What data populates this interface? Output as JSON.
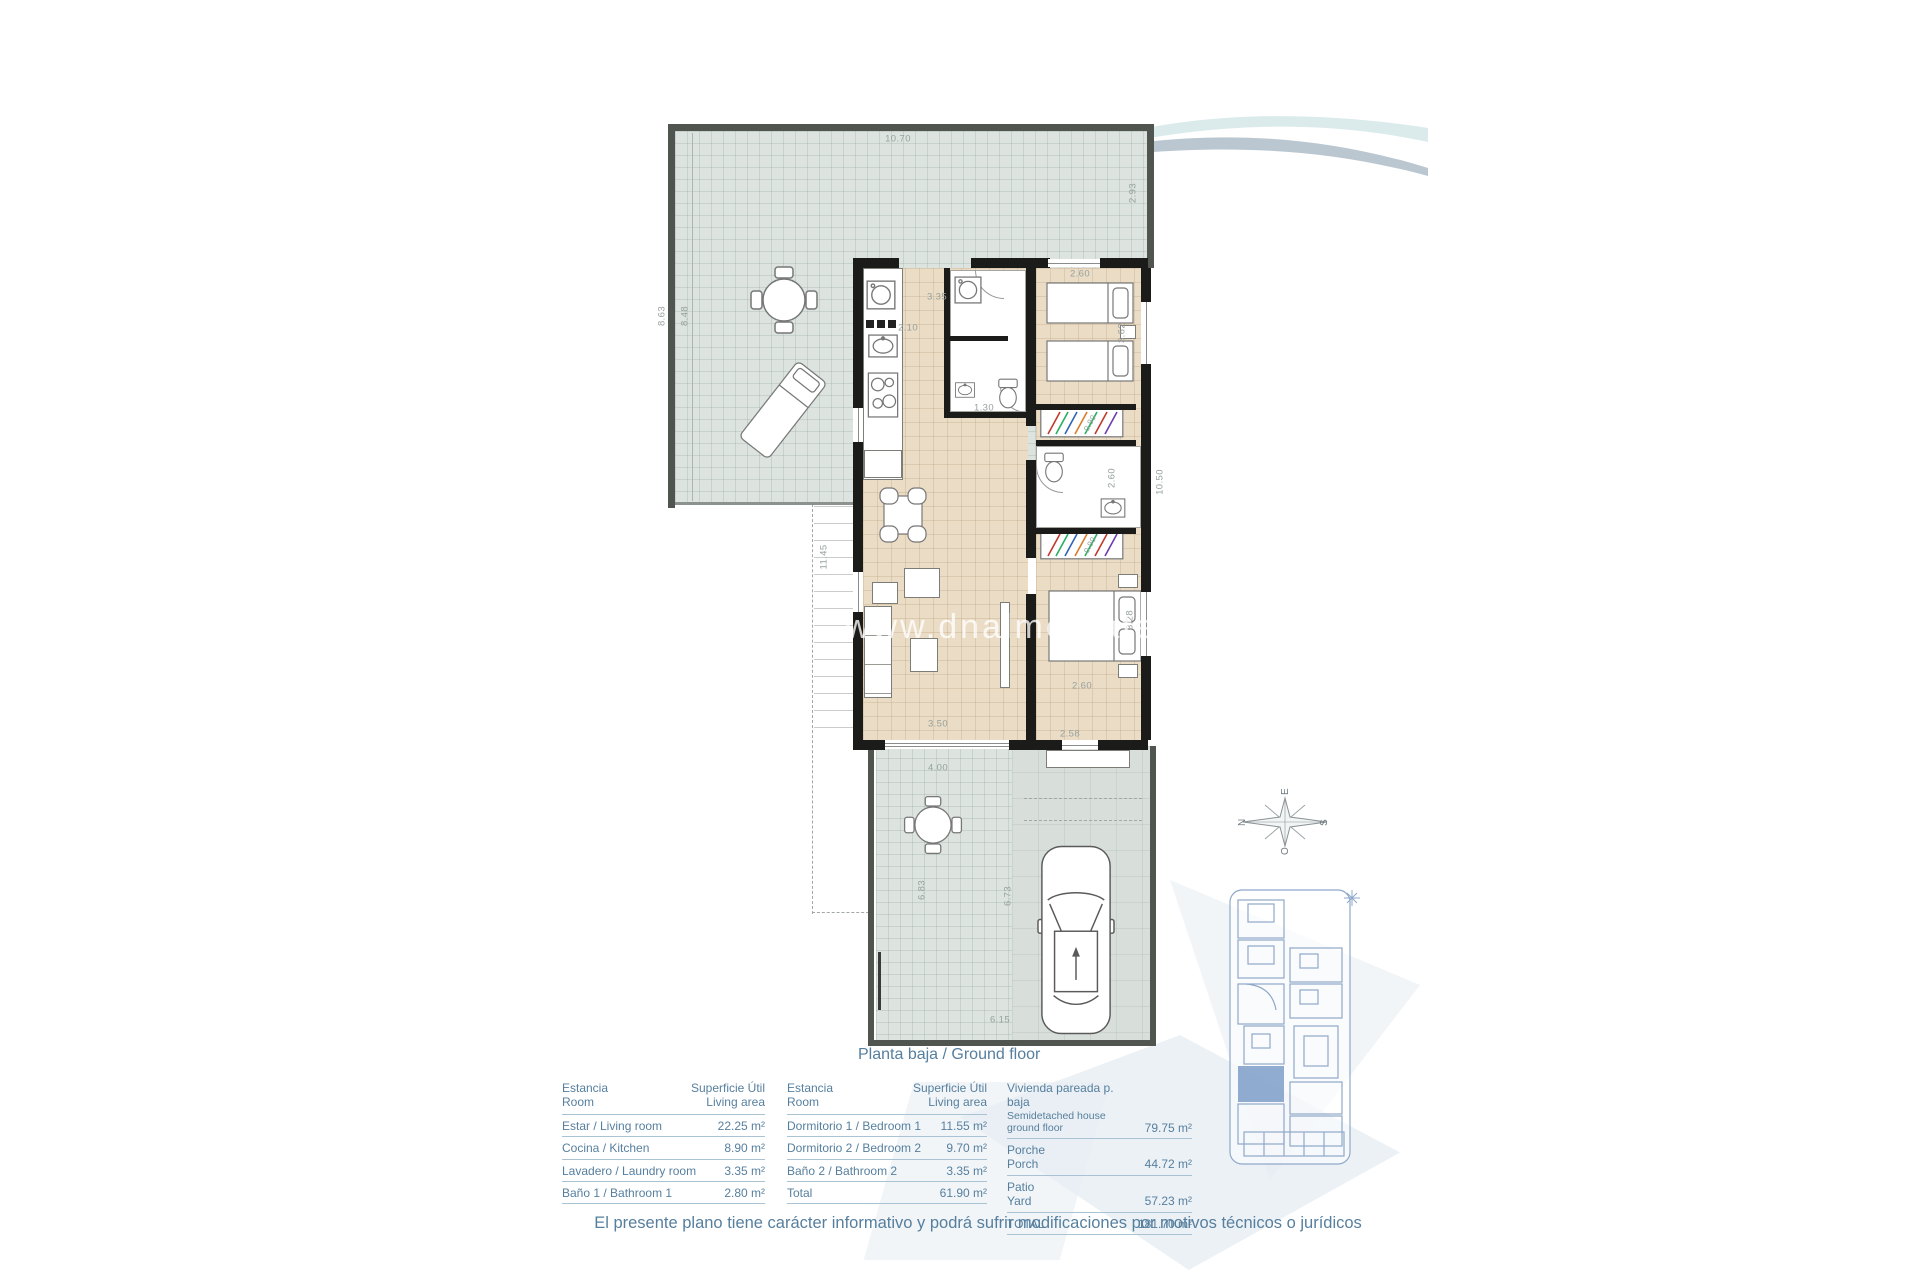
{
  "plan": {
    "watermark": "www.dnalmestate",
    "caption": "Planta baja / Ground floor",
    "disclaimer": "El presente plano tiene carácter informativo y podrá sufrir modificaciones por motivos técnicos o jurídicos"
  },
  "compass": {
    "north": "N",
    "south": "S",
    "east": "E",
    "west": "O"
  },
  "dimensions": {
    "terrace_top": "10.70",
    "terrace_right": "2.93",
    "terrace_left_outer": "8.63",
    "terrace_left_inner": "8.48",
    "entry_width": "3.35",
    "kitchen_width": "2.10",
    "bedroom1_width": "2.60",
    "bedroom1_depth": "3.62",
    "hall": "1.30",
    "house_right_depth": "10.50",
    "house_left_depth": "11.45",
    "bathroom2_depth": "2.60",
    "wardrobe1_width": "0.90",
    "wardrobe2_width": "0.90",
    "bedroom2_depth": "3.28",
    "bedroom2_width": "2.60",
    "living_width": "3.50",
    "porch_width": "2.58",
    "patio_width": "4.00",
    "patio_left_depth": "6.83",
    "patio_right_depth": "6.73",
    "patio_bottom_width": "6.15"
  },
  "tables": {
    "rooms1": {
      "header": {
        "col1_line1": "Estancia",
        "col1_line2": "Room",
        "col2_line1": "Superficie Útil",
        "col2_line2": "Living area"
      },
      "rows": [
        {
          "label": "Estar / Living room",
          "value": "22.25 m²"
        },
        {
          "label": "Cocina / Kitchen",
          "value": "8.90 m²"
        },
        {
          "label": "Lavadero / Laundry room",
          "value": "3.35 m²"
        },
        {
          "label": "Baño 1 / Bathroom 1",
          "value": "2.80 m²"
        }
      ]
    },
    "rooms2": {
      "header": {
        "col1_line1": "Estancia",
        "col1_line2": "Room",
        "col2_line1": "Superficie Útil",
        "col2_line2": "Living area"
      },
      "rows": [
        {
          "label": "Dormitorio 1 / Bedroom 1",
          "value": "11.55 m²"
        },
        {
          "label": "Dormitorio 2 / Bedroom 2",
          "value": "9.70 m²"
        },
        {
          "label": "Baño 2 / Bathroom 2",
          "value": "3.35 m²"
        },
        {
          "label": "Total",
          "value": "61.90 m²"
        }
      ]
    },
    "summary": {
      "rows": [
        {
          "label_es": "Vivienda pareada p. baja",
          "label_en": "Semidetached house ground floor",
          "value": "79.75 m²"
        },
        {
          "label_es": "Porche",
          "label_en": "Porch",
          "value": "44.72 m²"
        },
        {
          "label_es": "Patio",
          "label_en": "Yard",
          "value": "57.23 m²"
        },
        {
          "label_es": "TOTAL",
          "label_en": "",
          "value": "181.70 m²"
        }
      ]
    }
  }
}
